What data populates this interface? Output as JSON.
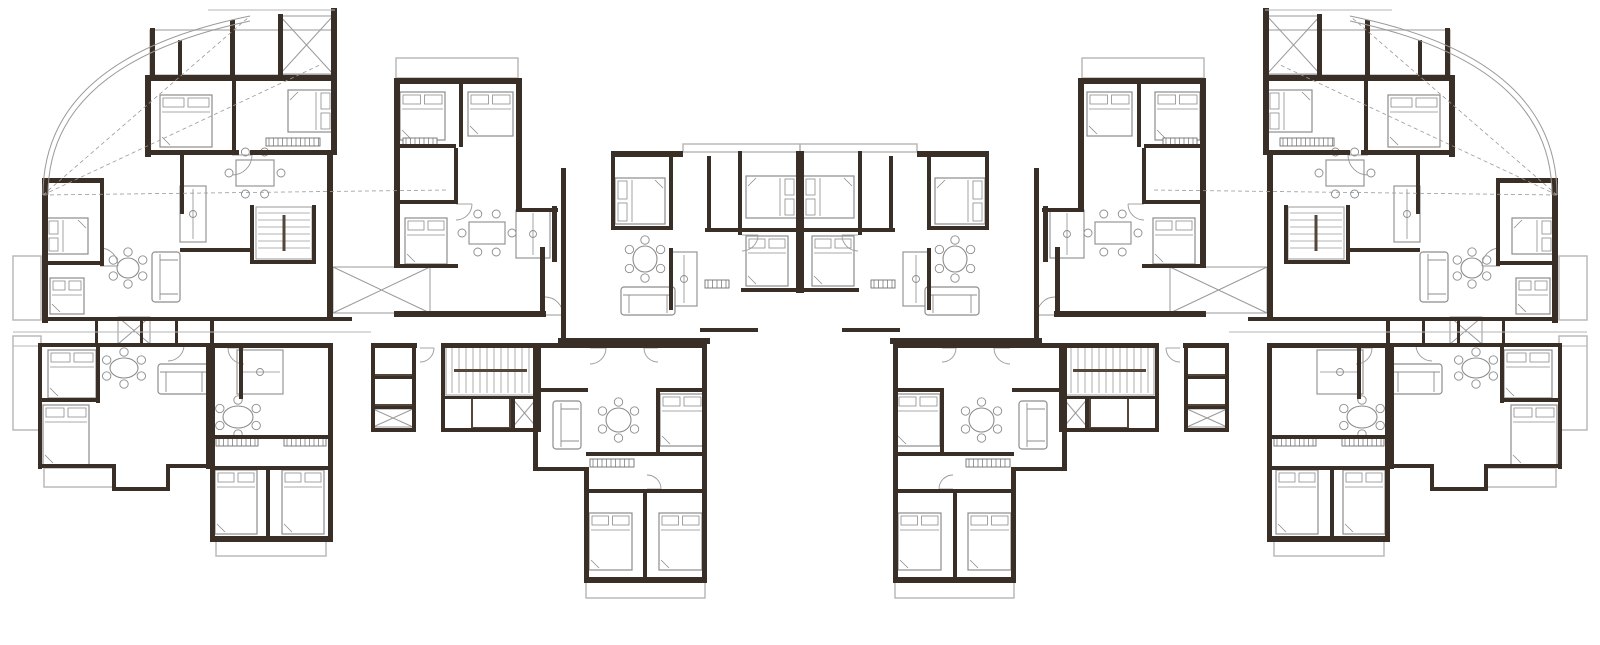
{
  "canvas": {
    "width": 1600,
    "height": 645,
    "background": "#ffffff",
    "mirror_axis": 800
  },
  "palette": {
    "wall": "#3a2f26",
    "wall_soft": "#55463a",
    "furniture": "#8c8c8c",
    "thin": "#9a9a9a",
    "light": "#b5b5b5",
    "hatch": "#6f6f6f",
    "background": "#ffffff"
  },
  "plan": {
    "walls": [
      [
        145,
        75,
        192,
        6
      ],
      [
        145,
        75,
        6,
        82
      ],
      [
        331,
        75,
        6,
        80
      ],
      [
        145,
        150,
        94,
        5
      ],
      [
        250,
        150,
        87,
        5
      ],
      [
        232,
        75,
        4,
        80
      ],
      [
        42,
        178,
        6,
        145
      ],
      [
        42,
        178,
        62,
        5
      ],
      [
        100,
        178,
        4,
        88
      ],
      [
        42,
        261,
        62,
        4
      ],
      [
        42,
        317,
        310,
        4
      ],
      [
        95,
        317,
        3,
        30
      ],
      [
        140,
        317,
        3,
        30
      ],
      [
        175,
        317,
        3,
        30
      ],
      [
        210,
        317,
        4,
        30
      ],
      [
        180,
        152,
        4,
        62
      ],
      [
        250,
        205,
        4,
        58
      ],
      [
        312,
        205,
        4,
        58
      ],
      [
        250,
        260,
        66,
        4
      ],
      [
        180,
        248,
        72,
        4
      ],
      [
        327,
        150,
        6,
        170
      ],
      [
        371,
        343,
        46,
        5
      ],
      [
        371,
        343,
        4,
        89
      ],
      [
        412,
        343,
        4,
        89
      ],
      [
        371,
        376,
        43,
        3
      ],
      [
        371,
        406,
        43,
        3
      ],
      [
        371,
        428,
        45,
        4
      ],
      [
        441,
        343,
        100,
        5
      ],
      [
        441,
        343,
        4,
        89
      ],
      [
        537,
        343,
        4,
        89
      ],
      [
        441,
        396,
        100,
        3
      ],
      [
        441,
        428,
        100,
        4
      ],
      [
        511,
        396,
        4,
        34
      ],
      [
        394,
        78,
        128,
        6
      ],
      [
        394,
        78,
        6,
        92
      ],
      [
        516,
        78,
        6,
        74
      ],
      [
        459,
        78,
        4,
        69
      ],
      [
        394,
        144,
        62,
        4
      ],
      [
        394,
        148,
        6,
        120
      ],
      [
        394,
        200,
        64,
        4
      ],
      [
        454,
        148,
        4,
        56
      ],
      [
        516,
        148,
        6,
        62
      ],
      [
        516,
        208,
        42,
        4
      ],
      [
        552,
        206,
        5,
        56
      ],
      [
        394,
        264,
        64,
        4
      ],
      [
        394,
        311,
        152,
        6
      ],
      [
        540,
        247,
        5,
        68
      ],
      [
        611,
        151,
        72,
        6
      ],
      [
        561,
        168,
        5,
        177
      ],
      [
        611,
        151,
        4,
        79
      ],
      [
        669,
        156,
        4,
        74
      ],
      [
        707,
        156,
        4,
        76
      ],
      [
        738,
        151,
        4,
        84
      ],
      [
        611,
        226,
        62,
        4
      ],
      [
        705,
        228,
        95,
        4
      ],
      [
        741,
        288,
        59,
        4
      ],
      [
        796,
        151,
        8,
        142
      ],
      [
        669,
        248,
        4,
        62
      ],
      [
        558,
        338,
        152,
        6
      ],
      [
        700,
        328,
        58,
        4
      ],
      [
        533,
        343,
        174,
        5
      ],
      [
        533,
        343,
        5,
        50
      ],
      [
        533,
        388,
        55,
        4
      ],
      [
        533,
        388,
        5,
        83
      ],
      [
        533,
        467,
        55,
        4
      ],
      [
        584,
        467,
        5,
        116
      ],
      [
        702,
        343,
        5,
        240
      ],
      [
        584,
        577,
        123,
        6
      ],
      [
        643,
        489,
        4,
        90
      ],
      [
        586,
        452,
        118,
        4
      ],
      [
        586,
        489,
        118,
        4
      ],
      [
        656,
        388,
        50,
        4
      ],
      [
        656,
        388,
        4,
        66
      ],
      [
        210,
        343,
        5,
        198
      ],
      [
        210,
        343,
        123,
        5
      ],
      [
        328,
        343,
        5,
        198
      ],
      [
        210,
        536,
        123,
        6
      ],
      [
        266,
        468,
        4,
        70
      ],
      [
        210,
        435,
        120,
        4
      ],
      [
        210,
        466,
        120,
        4
      ],
      [
        239,
        343,
        4,
        56
      ],
      [
        38,
        343,
        4,
        126
      ],
      [
        38,
        343,
        174,
        4
      ],
      [
        38,
        464,
        78,
        4
      ],
      [
        112,
        464,
        4,
        26
      ],
      [
        112,
        487,
        58,
        4
      ],
      [
        166,
        464,
        4,
        27
      ],
      [
        166,
        464,
        44,
        4
      ],
      [
        96,
        345,
        4,
        58
      ],
      [
        38,
        398,
        60,
        4
      ],
      [
        206,
        343,
        4,
        126
      ]
    ],
    "wall_stubs": [
      [
        150,
        28,
        5,
        50
      ],
      [
        178,
        40,
        4,
        40
      ],
      [
        230,
        20,
        5,
        58
      ],
      [
        278,
        14,
        5,
        64
      ],
      [
        331,
        8,
        6,
        70
      ]
    ],
    "balconies": [
      [
        150,
        30,
        183,
        45
      ],
      [
        396,
        58,
        122,
        20
      ],
      [
        683,
        144,
        117,
        8
      ],
      [
        586,
        581,
        119,
        17
      ],
      [
        216,
        540,
        110,
        16
      ],
      [
        13,
        256,
        28,
        64
      ],
      [
        13,
        336,
        28,
        94
      ],
      [
        44,
        468,
        70,
        19
      ]
    ],
    "cross_decks": [
      [
        333,
        267,
        97,
        46
      ],
      [
        118,
        317,
        32,
        27
      ],
      [
        511,
        397,
        27,
        32
      ],
      [
        373,
        409,
        40,
        18
      ],
      [
        280,
        16,
        53,
        58
      ]
    ],
    "lift_boxes": [
      [
        373,
        346,
        40,
        29
      ],
      [
        373,
        377,
        40,
        28
      ],
      [
        472,
        398,
        38,
        30
      ]
    ],
    "stairs": [
      [
        256,
        207,
        56,
        52,
        "v"
      ],
      [
        446,
        346,
        89,
        49,
        "h"
      ]
    ],
    "wardrobe_hatches": [
      [
        403,
        138,
        34,
        8
      ],
      [
        266,
        138,
        54,
        8
      ],
      [
        705,
        280,
        24,
        8
      ],
      [
        590,
        459,
        44,
        8
      ],
      [
        216,
        438,
        42,
        8
      ],
      [
        284,
        438,
        42,
        8
      ]
    ],
    "beds": [
      [
        160,
        95,
        52,
        52,
        "t"
      ],
      [
        288,
        90,
        45,
        42,
        "r"
      ],
      [
        46,
        218,
        42,
        36,
        "l"
      ],
      [
        50,
        278,
        34,
        36,
        "t"
      ],
      [
        48,
        350,
        48,
        48,
        "t"
      ],
      [
        43,
        405,
        46,
        60,
        "t"
      ],
      [
        400,
        92,
        45,
        48,
        "t"
      ],
      [
        468,
        92,
        45,
        44,
        "t"
      ],
      [
        405,
        218,
        42,
        46,
        "t"
      ],
      [
        615,
        178,
        50,
        46,
        "l"
      ],
      [
        746,
        176,
        51,
        42,
        "r"
      ],
      [
        746,
        236,
        42,
        50,
        "t"
      ],
      [
        660,
        394,
        44,
        52,
        "t"
      ],
      [
        589,
        513,
        43,
        57,
        "t"
      ],
      [
        659,
        513,
        43,
        57,
        "t"
      ],
      [
        215,
        470,
        42,
        64,
        "t"
      ],
      [
        282,
        470,
        42,
        64,
        "t"
      ]
    ],
    "round_tables": [
      [
        110,
        251,
        36,
        34
      ],
      [
        216,
        399,
        44,
        36
      ],
      [
        599,
        401,
        39,
        38
      ],
      [
        626,
        239,
        38,
        40
      ],
      [
        103,
        351,
        42,
        34
      ]
    ],
    "rect_tables": [
      [
        231,
        154,
        48,
        38
      ],
      [
        464,
        216,
        46,
        34
      ]
    ],
    "sofas": [
      [
        152,
        252,
        28,
        50,
        "v"
      ],
      [
        158,
        364,
        52,
        30,
        "h"
      ],
      [
        621,
        287,
        54,
        28,
        "h"
      ],
      [
        553,
        401,
        28,
        48,
        "v"
      ]
    ],
    "counters": [
      [
        180,
        186,
        26,
        56
      ],
      [
        516,
        210,
        34,
        48
      ],
      [
        671,
        252,
        26,
        54
      ],
      [
        237,
        350,
        46,
        44
      ]
    ],
    "door_arcs": [
      [
        232,
        155,
        20,
        "se"
      ],
      [
        100,
        266,
        18,
        "ne"
      ],
      [
        168,
        345,
        16,
        "se"
      ],
      [
        244,
        348,
        16,
        "sw"
      ],
      [
        590,
        348,
        16,
        "se"
      ],
      [
        658,
        348,
        14,
        "sw"
      ],
      [
        456,
        204,
        16,
        "se"
      ],
      [
        545,
        315,
        18,
        "ne"
      ],
      [
        742,
        235,
        16,
        "se"
      ],
      [
        647,
        489,
        14,
        "ne"
      ],
      [
        420,
        348,
        14,
        "se"
      ]
    ],
    "corner_arcs": [
      {
        "x1": 43,
        "y1": 195,
        "cx": 43,
        "cy": 58,
        "x2": 250,
        "y2": 16
      },
      {
        "x1": 48,
        "y1": 195,
        "cx": 48,
        "cy": 64,
        "x2": 250,
        "y2": 21
      }
    ],
    "radial_lines": [
      [
        43,
        195,
        250,
        16
      ],
      [
        43,
        195,
        322,
        64
      ],
      [
        43,
        195,
        448,
        190
      ]
    ],
    "edge_lines": [
      [
        208,
        10,
        335,
        10
      ],
      [
        13,
        332,
        371,
        332
      ],
      [
        13,
        346,
        38,
        346
      ]
    ]
  }
}
